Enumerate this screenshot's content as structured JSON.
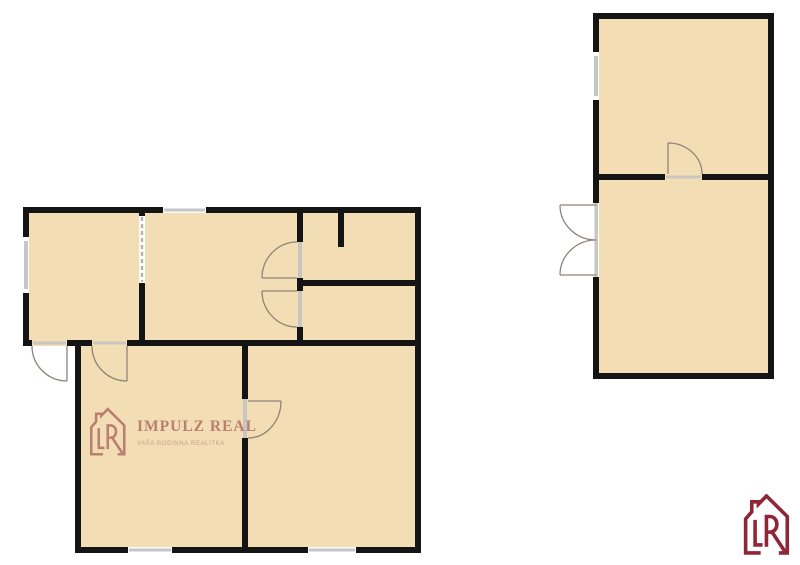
{
  "watermark": {
    "brand": "IMPULZ REAL",
    "tagline": "VAŠA RODINNÁ REALITKA",
    "icon": "house-r-logo"
  },
  "corner_logo": {
    "icon": "house-r-logo"
  },
  "colors": {
    "background": "#ffffff",
    "floor": "#f2ddb4",
    "wall": "#141414",
    "window_glass": "#c6c6c6",
    "door_sill": "#c9c6c1",
    "door_arc": "#8d8577",
    "dash_opening": "#b9b4ab",
    "watermark": "#b5786c",
    "watermark_sub": "#c79a8b",
    "logo": "#8e2638"
  }
}
